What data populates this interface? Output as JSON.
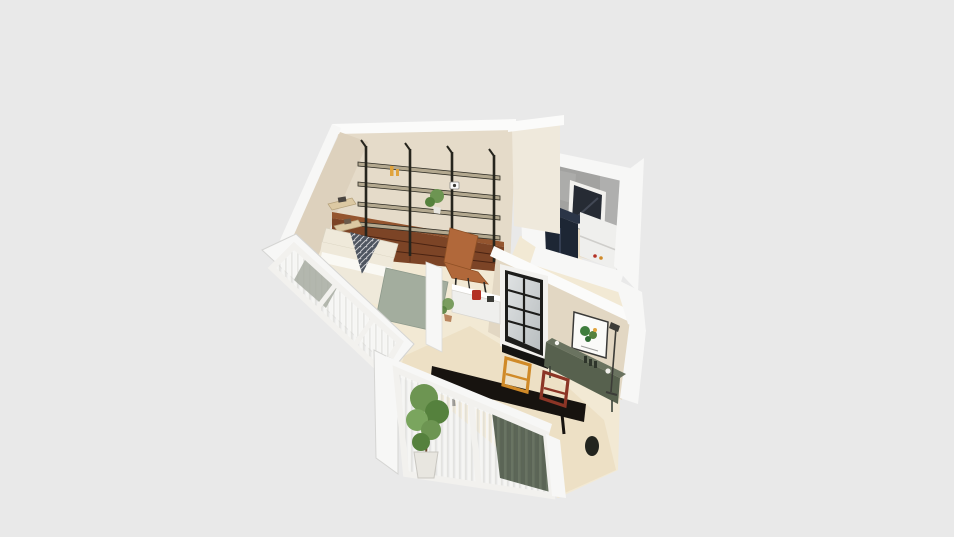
{
  "scene": {
    "type": "3d-floorplan-render",
    "view": "perspective top-down 3d view of a small apartment on plain backdrop",
    "rooms": [
      {
        "id": "bedroom",
        "items": [
          "industrial-wall-shelving",
          "walnut-drawer-cabinet",
          "floating-corner-shelves",
          "bed-with-patterned-pillow",
          "sage-green-bedding",
          "cognac-lounge-chair",
          "shelf-plant",
          "candle-decor",
          "speaker-decor",
          "sliding-window-sheer-curtains"
        ]
      },
      {
        "id": "bathroom-laundry",
        "items": [
          "concrete-feature-wall",
          "navy-storage-cabinet",
          "white-tall-cabinet",
          "dark-window"
        ]
      },
      {
        "id": "kitchen",
        "items": [
          "black-framed-window",
          "botanical-art-print",
          "green-sideboard-counter",
          "white-island-with-red-kettle",
          "floor-lamp",
          "small-floor-plant"
        ]
      },
      {
        "id": "dining-balcony",
        "items": [
          "black-dining-table",
          "orange-frame-chair",
          "red-frame-chair",
          "tall-potted-tree",
          "sliding-window-sheer-curtains",
          "dark-green-drapes",
          "dark-stool"
        ]
      }
    ]
  },
  "palette": {
    "background": "#e9e9e9",
    "wallWhite": "#f7f7f6",
    "wallWhiteBright": "#fbfbfa",
    "wallEdge": "#d5d5d3",
    "wallBeige": "#e5dbc9",
    "wallBeigeShade": "#ddd1bd",
    "wallBeigeLight": "#efe9dc",
    "kitchenWall": "#e2d7c3",
    "concrete": "#a2a2a0",
    "concreteLight": "#b5b5b3",
    "floorCream": "#f2e9d4",
    "floorTan": "#e9dcbd",
    "floorBath": "#e9ddc6",
    "shelfBlack": "#26251d",
    "shelfBoard": "#b3a88f",
    "cabinetWalnut": "#7c4426",
    "cabinetWalnutTop": "#94552f",
    "cabinetWalnutDark": "#4a2312",
    "woodLight": "#dcc9a3",
    "chairCognac": "#b1683a",
    "bedCream": "#efe9da",
    "bedSage": "#a3ad9e",
    "pillowDark": "#4e5560",
    "navyCabinet": "#1d2634",
    "navyCabinetTop": "#2b3547",
    "whiteCabinet": "#efefed",
    "applianceShade": "#d8d7d4",
    "darkWindow": "#262b34",
    "windowFrame": "#f2f1ee",
    "frameBlack": "#1d1d1b",
    "glassLight": "#dfe2e3",
    "glassDark": "#b9bec0",
    "sheerStripe": "#f6f6f4",
    "curtainGreen": "#4f5a4a",
    "curtainGreenLight": "#5d6957",
    "tableBlack": "#17130f",
    "chairOrange": "#d08a28",
    "chairRed": "#8c3526",
    "counterGreen": "#57614e",
    "counterGreenTop": "#6a7360",
    "plantGreen": "#6d9552",
    "plantGreenDark": "#55813d",
    "plantGreenLight": "#7aa55e",
    "potWhite": "#e8e6e0",
    "potClay": "#b9855f",
    "artGreen": "#3f7d3d",
    "accentRed": "#b33125",
    "accentYellow": "#e0a33c",
    "lampDark": "#3c3c38",
    "glassPanelGrey": "#a7aba1"
  }
}
